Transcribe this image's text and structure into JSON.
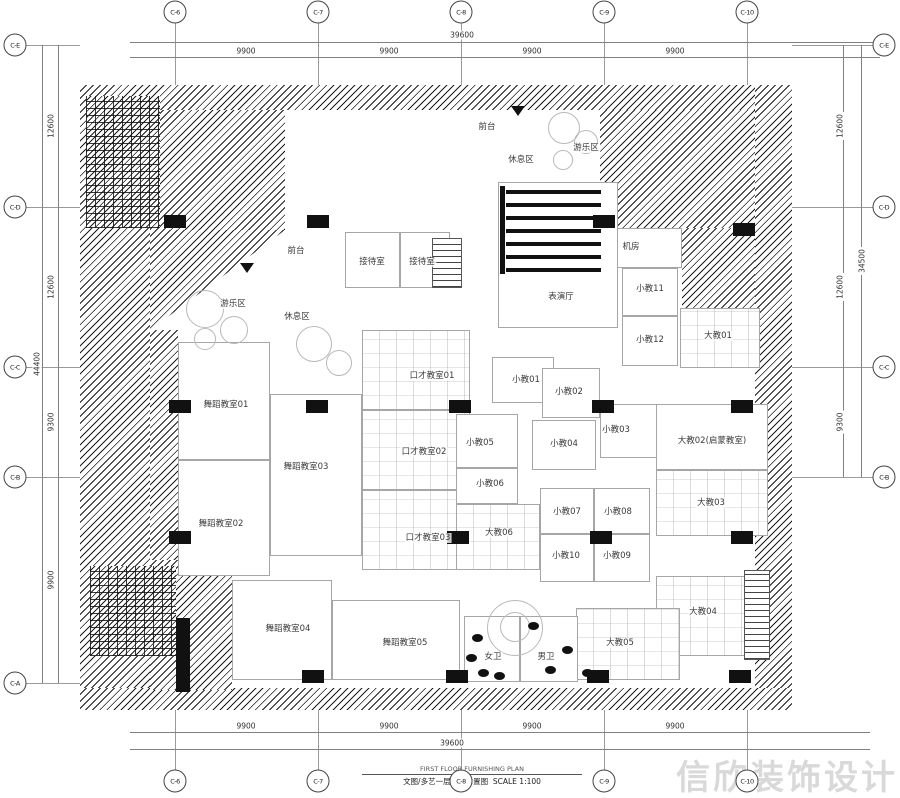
{
  "meta": {
    "watermark": "信欣装饰设计",
    "title_en": "FIRST FLOOR FURNISHING PLAN",
    "title_cn": "文图/多艺一层平面布置图",
    "scale": "SCALE 1:100"
  },
  "grid": {
    "cols": [
      {
        "label": "C-6",
        "x": 175
      },
      {
        "label": "C-7",
        "x": 318
      },
      {
        "label": "C-8",
        "x": 461
      },
      {
        "label": "C-9",
        "x": 604
      },
      {
        "label": "C-10",
        "x": 747
      }
    ],
    "rows_left": [
      {
        "label": "C-E",
        "y": 45
      },
      {
        "label": "C-D",
        "y": 207
      },
      {
        "label": "C-C",
        "y": 367
      },
      {
        "label": "C-B",
        "y": 477
      },
      {
        "label": "C-A",
        "y": 683
      }
    ],
    "rows_right": [
      {
        "label": "C-E",
        "y": 45
      },
      {
        "label": "C-D",
        "y": 207
      },
      {
        "label": "C-C",
        "y": 367
      },
      {
        "label": "C-B",
        "y": 477
      }
    ],
    "top_dims": {
      "total": "39600",
      "segments": [
        {
          "text": "9900",
          "x": 246
        },
        {
          "text": "9900",
          "x": 389
        },
        {
          "text": "9900",
          "x": 532
        },
        {
          "text": "9900",
          "x": 675
        }
      ]
    },
    "bottom_dims": {
      "total": "39600",
      "segments": [
        {
          "text": "9900",
          "x": 246
        },
        {
          "text": "9900",
          "x": 389
        },
        {
          "text": "9900",
          "x": 532
        },
        {
          "text": "9900",
          "x": 675
        }
      ]
    },
    "left_dims": {
      "total": "44400",
      "segments": [
        {
          "text": "12600",
          "y": 126
        },
        {
          "text": "12600",
          "y": 287
        },
        {
          "text": "9300",
          "y": 422
        },
        {
          "text": "9900",
          "y": 580
        }
      ]
    },
    "right_dims": {
      "total": "34500",
      "segments": [
        {
          "text": "12600",
          "y": 126
        },
        {
          "text": "12600",
          "y": 287
        },
        {
          "text": "9300",
          "y": 422
        }
      ]
    }
  },
  "rooms": [
    {
      "label": "接待室",
      "x": 345,
      "y": 232,
      "w": 55,
      "h": 56,
      "lx": 372,
      "ly": 262
    },
    {
      "label": "接待室",
      "x": 400,
      "y": 232,
      "w": 50,
      "h": 56,
      "lx": 422,
      "ly": 262
    },
    {
      "label": "机房",
      "x": 606,
      "y": 228,
      "w": 76,
      "h": 40,
      "lx": 631,
      "ly": 247
    },
    {
      "label": "小教11",
      "x": 622,
      "y": 268,
      "w": 56,
      "h": 48,
      "lx": 650,
      "ly": 289
    },
    {
      "label": "小教12",
      "x": 622,
      "y": 316,
      "w": 56,
      "h": 50,
      "lx": 650,
      "ly": 340
    },
    {
      "label": "大教01",
      "x": 680,
      "y": 308,
      "w": 80,
      "h": 60,
      "lx": 718,
      "ly": 336,
      "furn": true
    },
    {
      "label": "表演厅",
      "x": 498,
      "y": 182,
      "w": 120,
      "h": 146,
      "lx": 561,
      "ly": 297
    },
    {
      "label": "口才教室01",
      "x": 362,
      "y": 330,
      "w": 108,
      "h": 80,
      "lx": 432,
      "ly": 376,
      "furn": true
    },
    {
      "label": "口才教室02",
      "x": 362,
      "y": 410,
      "w": 108,
      "h": 80,
      "lx": 424,
      "ly": 452,
      "furn": true
    },
    {
      "label": "口才教室03",
      "x": 362,
      "y": 490,
      "w": 108,
      "h": 80,
      "lx": 428,
      "ly": 538,
      "furn": true
    },
    {
      "label": "小教01",
      "x": 492,
      "y": 357,
      "w": 62,
      "h": 46,
      "lx": 526,
      "ly": 380
    },
    {
      "label": "小教02",
      "x": 542,
      "y": 368,
      "w": 58,
      "h": 50,
      "lx": 569,
      "ly": 392
    },
    {
      "label": "小教03",
      "x": 600,
      "y": 404,
      "w": 60,
      "h": 54,
      "lx": 616,
      "ly": 430
    },
    {
      "label": "小教04",
      "x": 532,
      "y": 420,
      "w": 64,
      "h": 50,
      "lx": 564,
      "ly": 444
    },
    {
      "label": "小教05",
      "x": 456,
      "y": 414,
      "w": 62,
      "h": 54,
      "lx": 480,
      "ly": 443
    },
    {
      "label": "小教06",
      "x": 456,
      "y": 468,
      "w": 62,
      "h": 36,
      "lx": 490,
      "ly": 484
    },
    {
      "label": "小教07",
      "x": 540,
      "y": 488,
      "w": 54,
      "h": 46,
      "lx": 567,
      "ly": 512
    },
    {
      "label": "小教08",
      "x": 594,
      "y": 488,
      "w": 56,
      "h": 46,
      "lx": 618,
      "ly": 512
    },
    {
      "label": "小教09",
      "x": 594,
      "y": 534,
      "w": 56,
      "h": 48,
      "lx": 617,
      "ly": 556
    },
    {
      "label": "小教10",
      "x": 540,
      "y": 534,
      "w": 54,
      "h": 48,
      "lx": 566,
      "ly": 556
    },
    {
      "label": "大教06",
      "x": 456,
      "y": 504,
      "w": 84,
      "h": 66,
      "lx": 499,
      "ly": 533,
      "furn": true
    },
    {
      "label": "大教02(启蒙教室)",
      "x": 656,
      "y": 404,
      "w": 112,
      "h": 66,
      "lx": 712,
      "ly": 441
    },
    {
      "label": "大教03",
      "x": 656,
      "y": 470,
      "w": 112,
      "h": 66,
      "lx": 711,
      "ly": 503,
      "furn": true
    },
    {
      "label": "大教04",
      "x": 656,
      "y": 576,
      "w": 90,
      "h": 80,
      "lx": 703,
      "ly": 612,
      "furn": true
    },
    {
      "label": "大教05",
      "x": 576,
      "y": 608,
      "w": 104,
      "h": 72,
      "lx": 620,
      "ly": 643,
      "furn": true
    },
    {
      "label": "舞蹈教室01",
      "x": 178,
      "y": 342,
      "w": 92,
      "h": 118,
      "lx": 226,
      "ly": 405
    },
    {
      "label": "舞蹈教室02",
      "x": 178,
      "y": 460,
      "w": 92,
      "h": 116,
      "lx": 221,
      "ly": 524
    },
    {
      "label": "舞蹈教室03",
      "x": 270,
      "y": 394,
      "w": 92,
      "h": 162,
      "lx": 306,
      "ly": 467
    },
    {
      "label": "舞蹈教室04",
      "x": 232,
      "y": 580,
      "w": 100,
      "h": 100,
      "lx": 288,
      "ly": 629
    },
    {
      "label": "舞蹈教室05",
      "x": 332,
      "y": 600,
      "w": 128,
      "h": 80,
      "lx": 405,
      "ly": 643
    },
    {
      "label": "女卫",
      "x": 464,
      "y": 616,
      "w": 56,
      "h": 66,
      "lx": 493,
      "ly": 657
    },
    {
      "label": "男卫",
      "x": 520,
      "y": 616,
      "w": 58,
      "h": 66,
      "lx": 546,
      "ly": 657
    }
  ],
  "area_labels": [
    {
      "label": "前台",
      "x": 487,
      "y": 127
    },
    {
      "label": "休息区",
      "x": 521,
      "y": 160
    },
    {
      "label": "游乐区",
      "x": 586,
      "y": 148
    },
    {
      "label": "前台",
      "x": 296,
      "y": 251
    },
    {
      "label": "游乐区",
      "x": 233,
      "y": 304
    },
    {
      "label": "休息区",
      "x": 297,
      "y": 317
    }
  ],
  "columns": [
    [
      175,
      222
    ],
    [
      318,
      222
    ],
    [
      604,
      222
    ],
    [
      744,
      230
    ],
    [
      180,
      407
    ],
    [
      317,
      407
    ],
    [
      460,
      407
    ],
    [
      603,
      407
    ],
    [
      742,
      407
    ],
    [
      180,
      538
    ],
    [
      458,
      538
    ],
    [
      601,
      538
    ],
    [
      742,
      538
    ],
    [
      313,
      677
    ],
    [
      457,
      677
    ],
    [
      598,
      677
    ],
    [
      740,
      677
    ]
  ],
  "hatches": [
    {
      "x": 80,
      "y": 85,
      "w": 712,
      "h": 25,
      "k": "h"
    },
    {
      "x": 80,
      "y": 85,
      "w": 70,
      "h": 625,
      "k": "h"
    },
    {
      "x": 150,
      "y": 330,
      "w": 28,
      "h": 358,
      "k": "h"
    },
    {
      "x": 755,
      "y": 85,
      "w": 37,
      "h": 625,
      "k": "h"
    },
    {
      "x": 80,
      "y": 688,
      "w": 712,
      "h": 22,
      "k": "h"
    },
    {
      "x": 150,
      "y": 110,
      "w": 135,
      "h": 120,
      "k": "h"
    },
    {
      "x": 150,
      "y": 230,
      "w": 135,
      "h": 100,
      "k": "tri"
    },
    {
      "x": 600,
      "y": 110,
      "w": 155,
      "h": 118,
      "k": "h"
    },
    {
      "x": 682,
      "y": 228,
      "w": 73,
      "h": 80,
      "k": "h"
    },
    {
      "x": 150,
      "y": 560,
      "w": 82,
      "h": 130,
      "k": "h"
    },
    {
      "x": 86,
      "y": 96,
      "w": 74,
      "h": 132,
      "k": "d"
    },
    {
      "x": 90,
      "y": 566,
      "w": 86,
      "h": 90,
      "k": "d"
    }
  ],
  "shapes": [
    {
      "k": "bar",
      "x": 506,
      "y": 190,
      "w": 95,
      "h": 4
    },
    {
      "k": "bar",
      "x": 506,
      "y": 203,
      "w": 95,
      "h": 4
    },
    {
      "k": "bar",
      "x": 506,
      "y": 216,
      "w": 95,
      "h": 4
    },
    {
      "k": "bar",
      "x": 506,
      "y": 229,
      "w": 95,
      "h": 4
    },
    {
      "k": "bar",
      "x": 506,
      "y": 242,
      "w": 95,
      "h": 4
    },
    {
      "k": "bar",
      "x": 506,
      "y": 255,
      "w": 95,
      "h": 4
    },
    {
      "k": "bar",
      "x": 506,
      "y": 268,
      "w": 95,
      "h": 4
    },
    {
      "k": "bar",
      "x": 500,
      "y": 186,
      "w": 5,
      "h": 88
    },
    {
      "k": "bar",
      "x": 176,
      "y": 618,
      "w": 14,
      "h": 74
    },
    {
      "k": "stairs",
      "x": 432,
      "y": 238,
      "w": 30,
      "h": 50
    },
    {
      "k": "stairs",
      "x": 744,
      "y": 570,
      "w": 26,
      "h": 90
    },
    {
      "k": "tri",
      "x": 511,
      "y": 106
    },
    {
      "k": "tri",
      "x": 240,
      "y": 263
    },
    {
      "k": "circ",
      "x": 548,
      "y": 112,
      "d": 30
    },
    {
      "k": "circ",
      "x": 574,
      "y": 130,
      "d": 22
    },
    {
      "k": "circ",
      "x": 553,
      "y": 150,
      "d": 18
    },
    {
      "k": "circ",
      "x": 186,
      "y": 290,
      "d": 36
    },
    {
      "k": "circ",
      "x": 220,
      "y": 316,
      "d": 26
    },
    {
      "k": "circ",
      "x": 194,
      "y": 328,
      "d": 20
    },
    {
      "k": "circ",
      "x": 296,
      "y": 326,
      "d": 34
    },
    {
      "k": "circ",
      "x": 326,
      "y": 350,
      "d": 24
    },
    {
      "k": "circ",
      "x": 487,
      "y": 600,
      "d": 54
    },
    {
      "k": "circ",
      "x": 500,
      "y": 612,
      "d": 28
    },
    {
      "k": "fix",
      "x": 472,
      "y": 634
    },
    {
      "k": "fix",
      "x": 466,
      "y": 654
    },
    {
      "k": "fix",
      "x": 478,
      "y": 669
    },
    {
      "k": "fix",
      "x": 494,
      "y": 672
    },
    {
      "k": "fix",
      "x": 528,
      "y": 622
    },
    {
      "k": "fix",
      "x": 545,
      "y": 666
    },
    {
      "k": "fix",
      "x": 562,
      "y": 646
    },
    {
      "k": "fix",
      "x": 582,
      "y": 669
    }
  ]
}
